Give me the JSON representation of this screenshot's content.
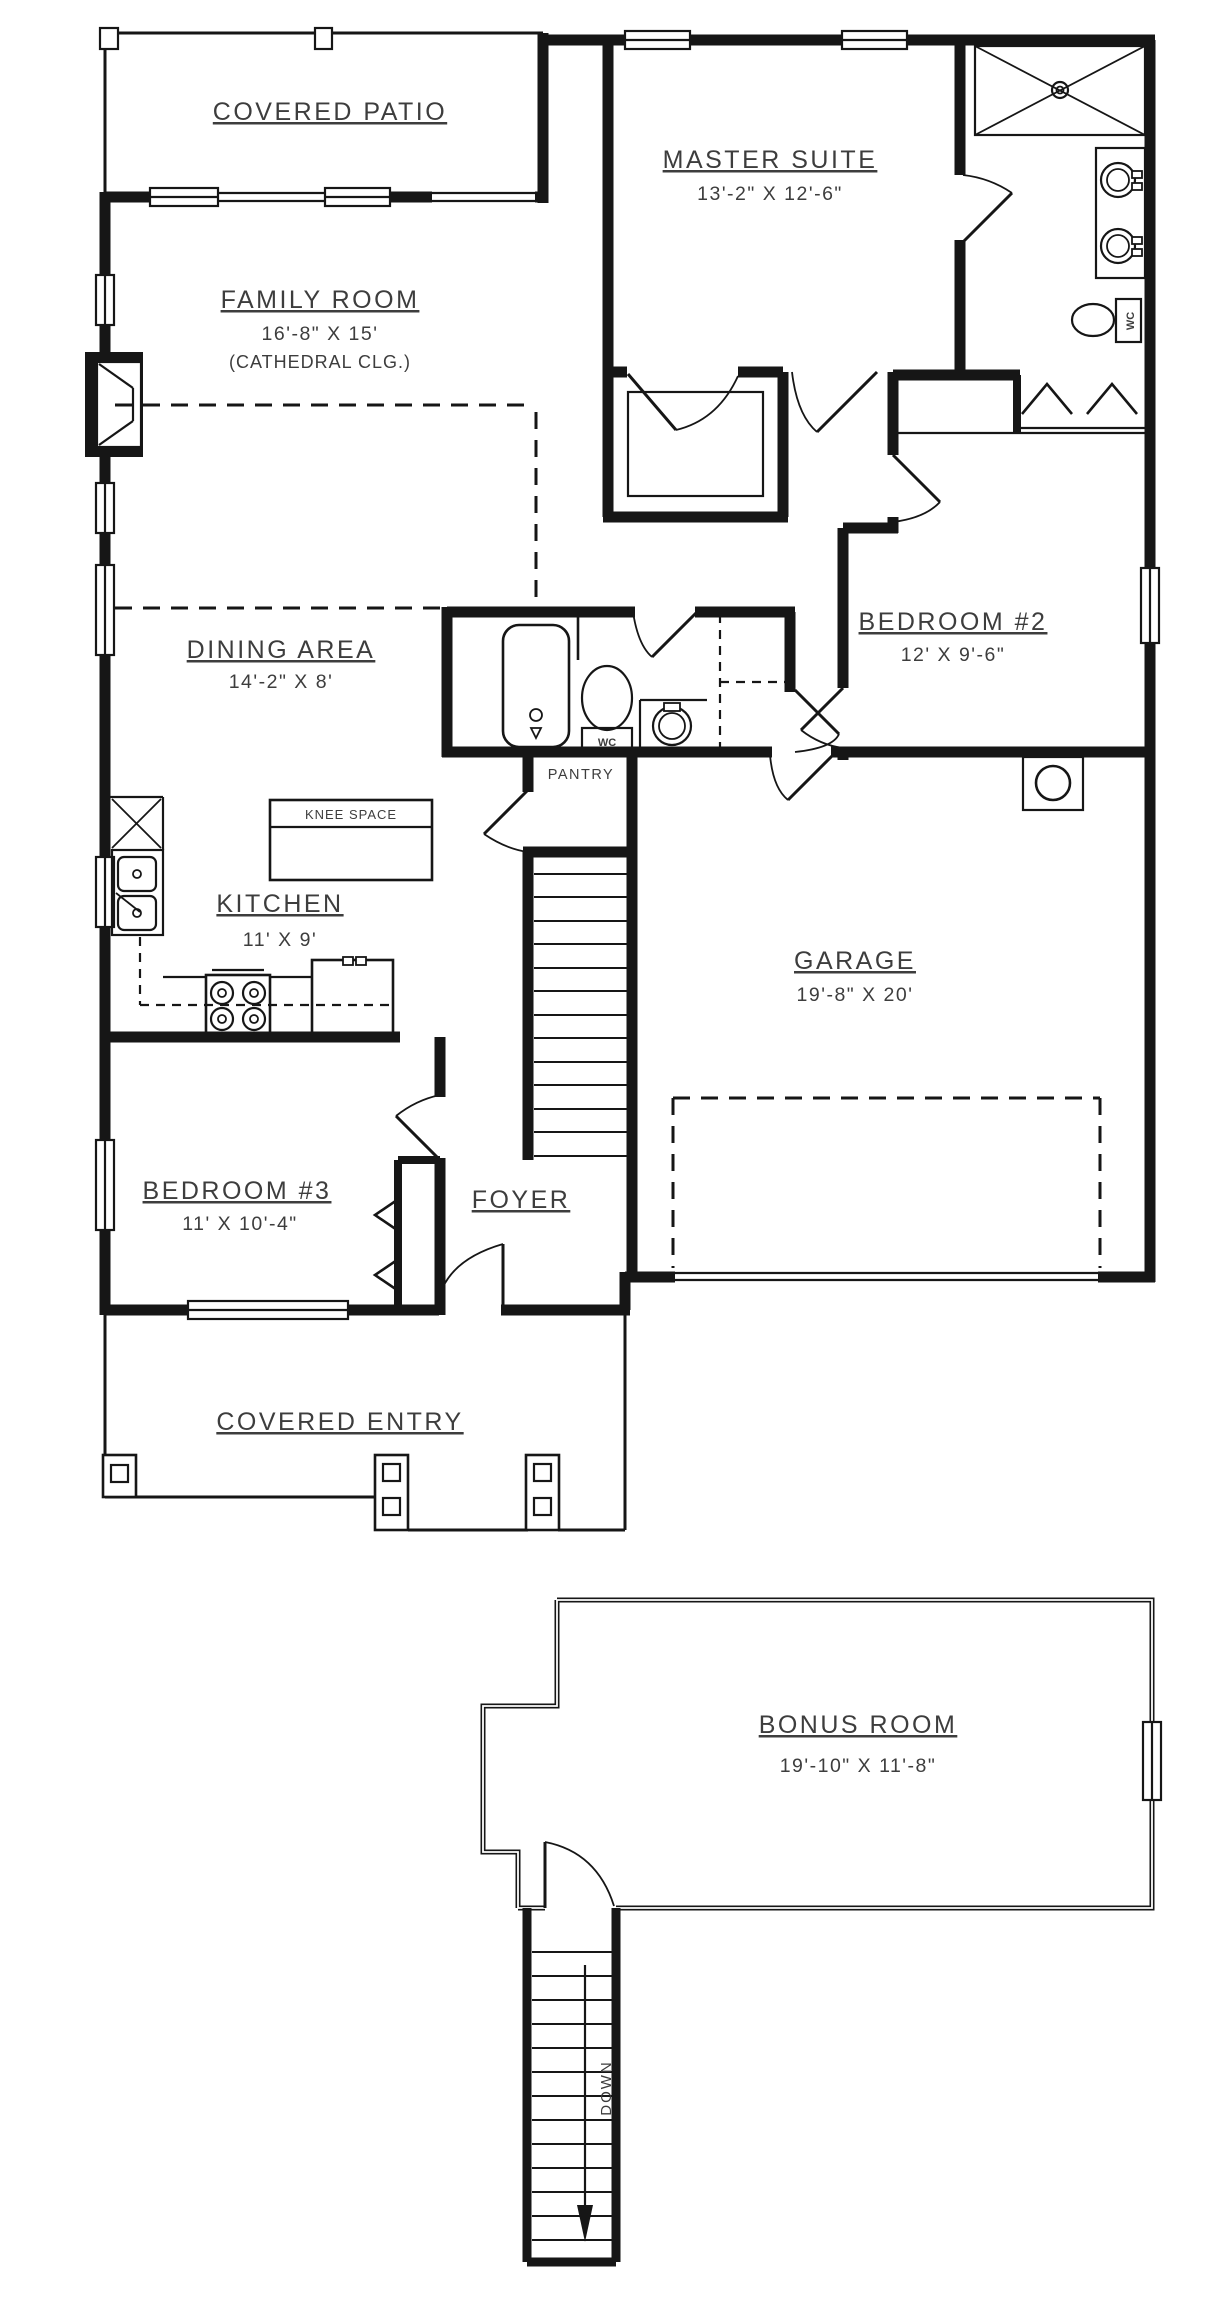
{
  "drawing": {
    "type": "residential floor plan, two sheets: main floor and bonus room level",
    "colors": {
      "wall": "#161616",
      "text": "#3d3d3d",
      "background": "#ffffff"
    }
  },
  "rooms": {
    "covered_patio": {
      "label": "COVERED PATIO"
    },
    "family_room": {
      "label": "FAMILY ROOM",
      "dims": "16'-8\" X 15'",
      "note": "(CATHEDRAL CLG.)"
    },
    "master_suite": {
      "label": "MASTER SUITE",
      "dims": "13'-2\" X 12'-6\""
    },
    "dining_area": {
      "label": "DINING AREA",
      "dims": "14'-2\" X 8'"
    },
    "bedroom_2": {
      "label": "BEDROOM #2",
      "dims": "12' X 9'-6\""
    },
    "kitchen": {
      "label": "KITCHEN",
      "dims": "11' X 9'"
    },
    "knee_space": {
      "label": "KNEE SPACE"
    },
    "pantry": {
      "label": "PANTRY"
    },
    "garage": {
      "label": "GARAGE",
      "dims": "19'-8\" X 20'"
    },
    "bedroom_3": {
      "label": "BEDROOM #3",
      "dims": "11' X 10'-4\""
    },
    "foyer": {
      "label": "FOYER"
    },
    "covered_entry": {
      "label": "COVERED ENTRY"
    },
    "bonus_room": {
      "label": "BONUS ROOM",
      "dims": "19'-10\" X 11'-8\""
    }
  },
  "annotations": {
    "wc": "WC",
    "down": "DOWN"
  }
}
